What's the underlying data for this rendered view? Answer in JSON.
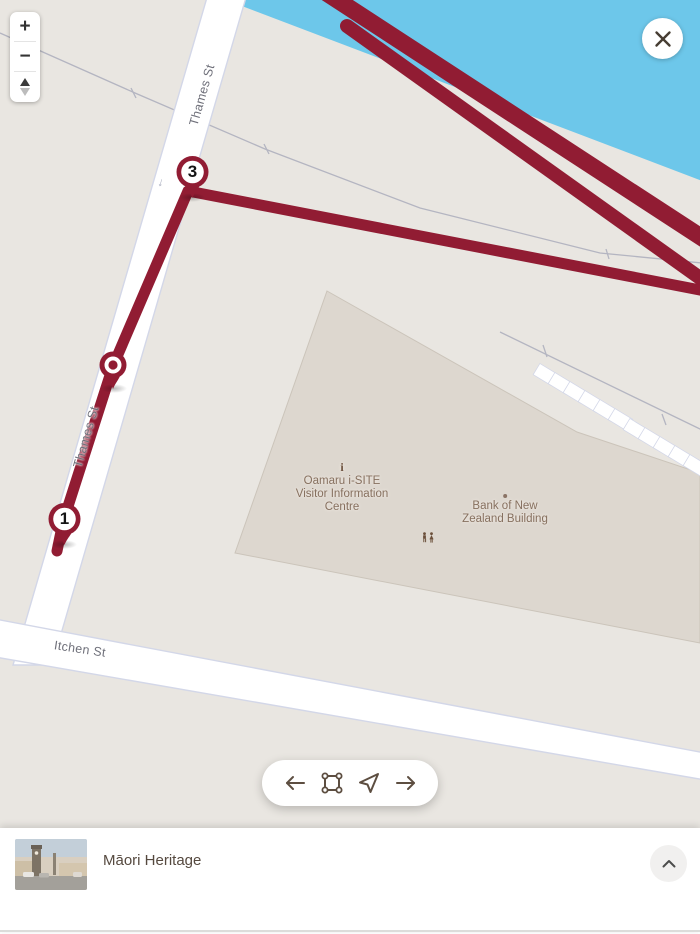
{
  "app": {
    "type": "walking-tour-map"
  },
  "colors": {
    "route": "#911c33",
    "water": "#6dc7ea",
    "map_bg": "#e9e6e1",
    "building": "#ddd7cf",
    "icon_brown": "#5d4e41"
  },
  "zoom_controls": {
    "zoom_in": "+",
    "zoom_out": "−",
    "compass_icon": "compass-pitch-toggle"
  },
  "close": {
    "icon": "close-icon"
  },
  "map": {
    "street_labels": {
      "thames_upper": "Thames St",
      "thames_lower": "Thames St",
      "itchen": "Itchen St"
    },
    "poi": {
      "isite": {
        "icon": "info-icon",
        "symbol": "i",
        "line1": "Oamaru i-SITE",
        "line2": "Visitor Information",
        "line3": "Centre"
      },
      "bnz": {
        "icon": "dot-icon",
        "line1": "Bank of New",
        "line2": "Zealand Building"
      },
      "restroom": {
        "icon": "restroom-icon"
      }
    },
    "markers": {
      "m3": "3",
      "m1": "1",
      "mid": "ring-stop-marker"
    },
    "oneway_arrow": "↓"
  },
  "toolbar": {
    "back": "arrow-left-icon",
    "fit_bounds": "bounds-corners-icon",
    "locate": "navigate-arrow-icon",
    "forward": "arrow-right-icon"
  },
  "bottom_bar": {
    "title": "Māori Heritage",
    "thumbnail": "oamaru-clock-tower-photo",
    "collapse_icon": "chevron-up-icon"
  }
}
